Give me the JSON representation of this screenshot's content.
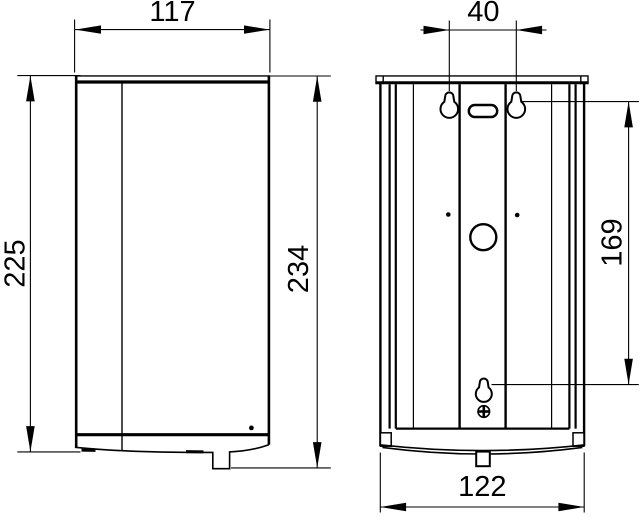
{
  "drawing": {
    "background_color": "#ffffff",
    "line_color": "#000000",
    "views": {
      "front": {
        "width_label": "117",
        "height_left_label": "225",
        "height_right_label": "234"
      },
      "rear": {
        "hole_spacing_label": "40",
        "hole_vertical_label": "169",
        "width_label": "122"
      }
    }
  }
}
